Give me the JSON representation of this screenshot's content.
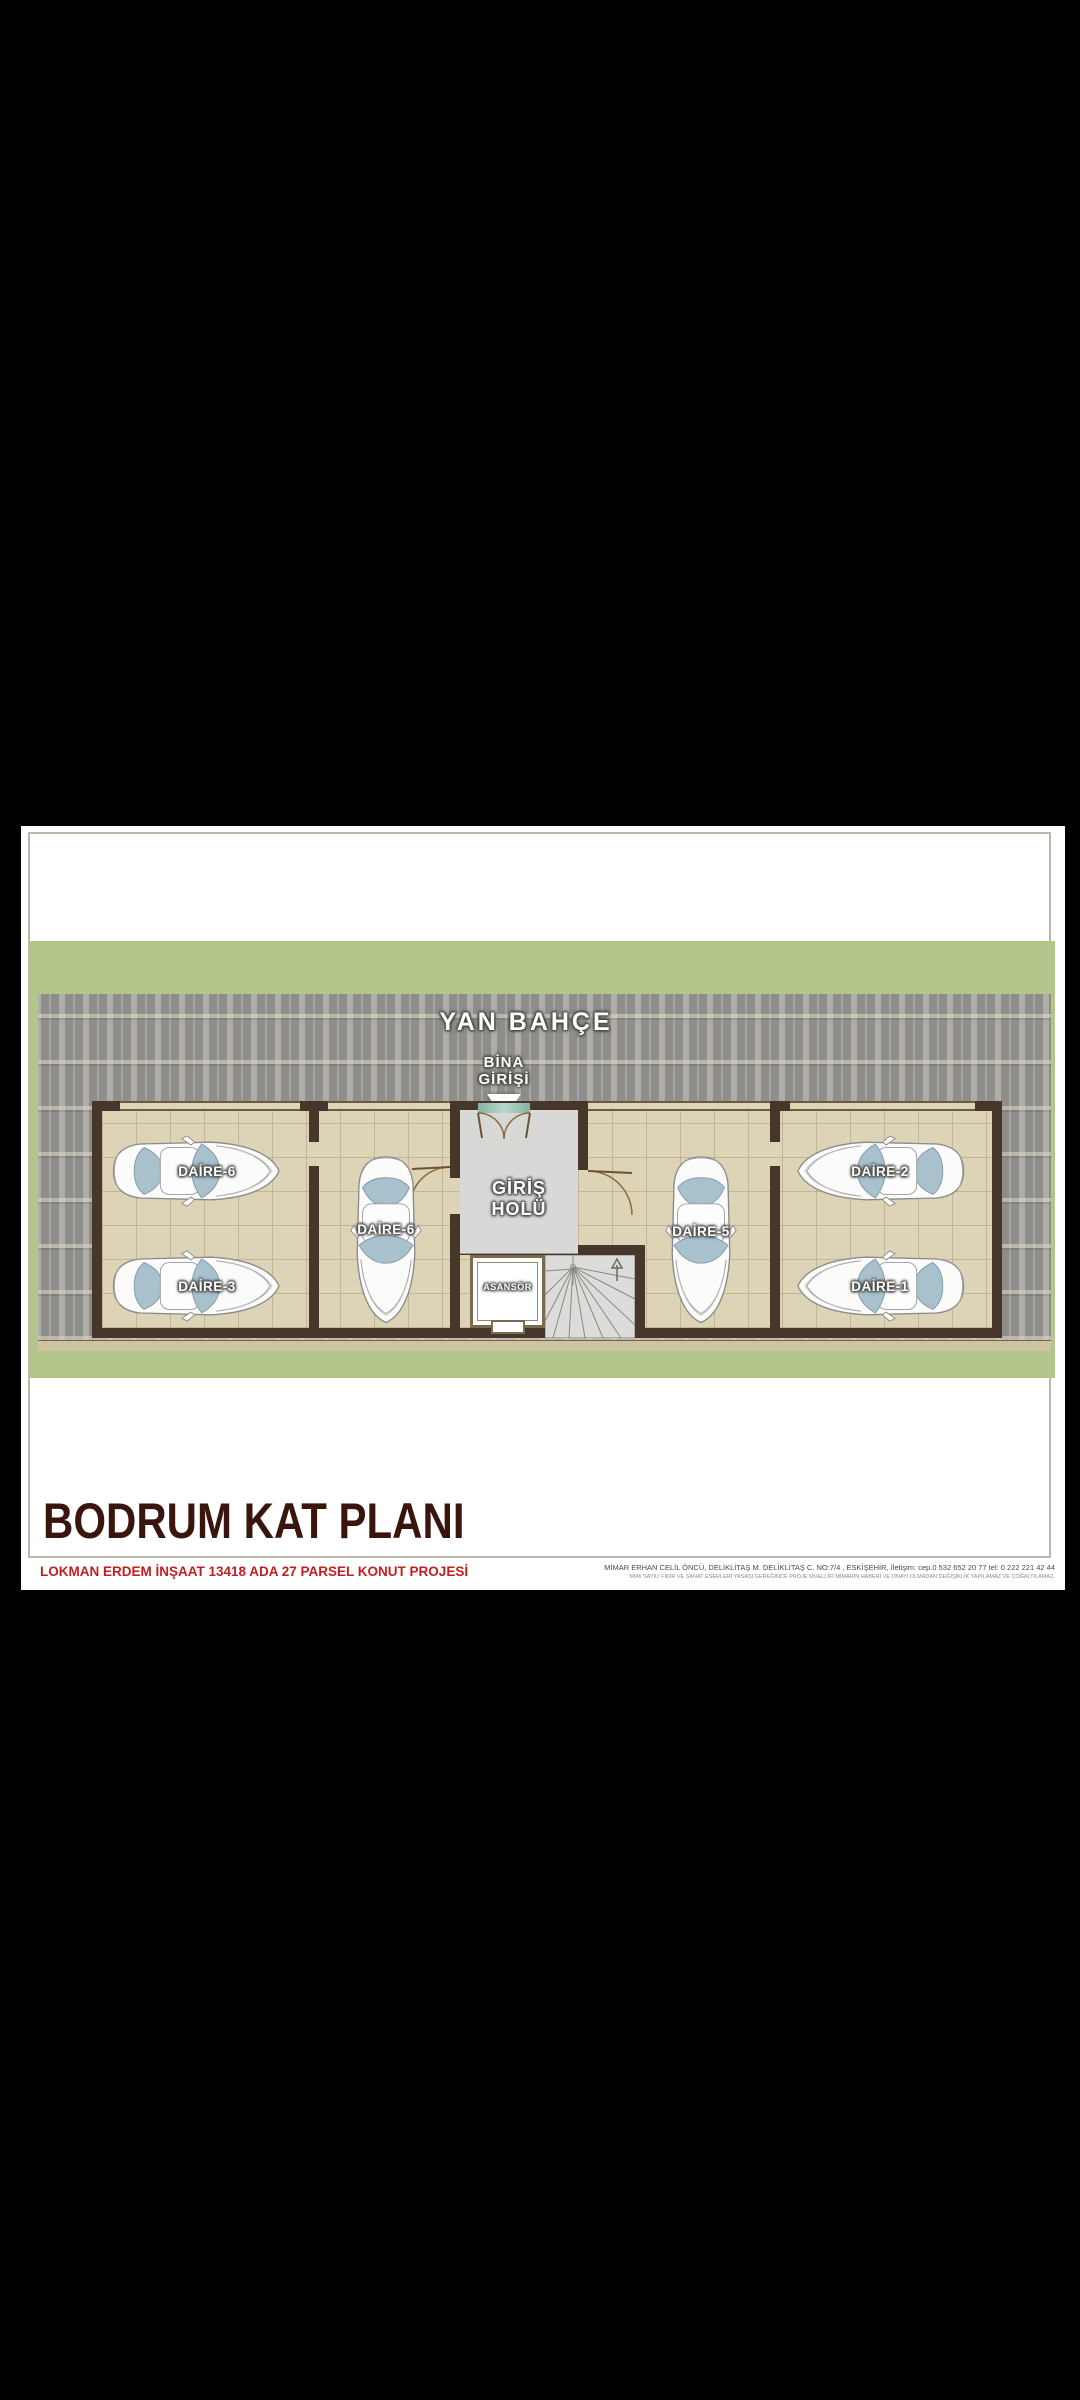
{
  "window": {
    "background": "#000000"
  },
  "plan": {
    "garden_label": "YAN BAHÇE",
    "entrance_label_line1": "BİNA",
    "entrance_label_line2": "GİRİŞİ",
    "hall_label_line1": "GİRİŞ",
    "hall_label_line2": "HOLÜ",
    "elevator_label": "ASANSÖR",
    "parking_labels": [
      "DAİRE-6",
      "DAİRE-3",
      "DAİRE-6",
      "DAİRE-5",
      "DAİRE-2",
      "DAİRE-1"
    ],
    "colors": {
      "garden": "#b2c68c",
      "paving": "#9a9a98",
      "floor_tile": "#ddd3b6",
      "hall_floor": "#d8d8d6",
      "wall": "#46372a",
      "doormat": "#8fbfae",
      "title": "#3a150e",
      "project_red": "#c41e1e"
    }
  },
  "titleblock": {
    "title": "BODRUM KAT PLANI",
    "project_line": "LOKMAN ERDEM İNŞAAT 13418 ADA 27 PARSEL KONUT PROJESİ",
    "architect_line1": "MİMAR ERHAN CELİL ÖNCÜ, DELİKLİTAŞ M. DELİKLİTAŞ C. NO:7/4 , ESKİŞEHİR, İletişim: cep.0 532 652 20 77 tel: 0 222 221 42 44",
    "architect_line2": "5846 SAYILI FİKİR VE SANAT ESERLERİ YASASI GEREĞİNCE PROJE MÜELLİFİ MİMARIN HABERİ VE ONAYI OLMADAN DEĞİŞİKLİK YAPILAMAZ VE ÇOĞALTILAMAZ."
  }
}
